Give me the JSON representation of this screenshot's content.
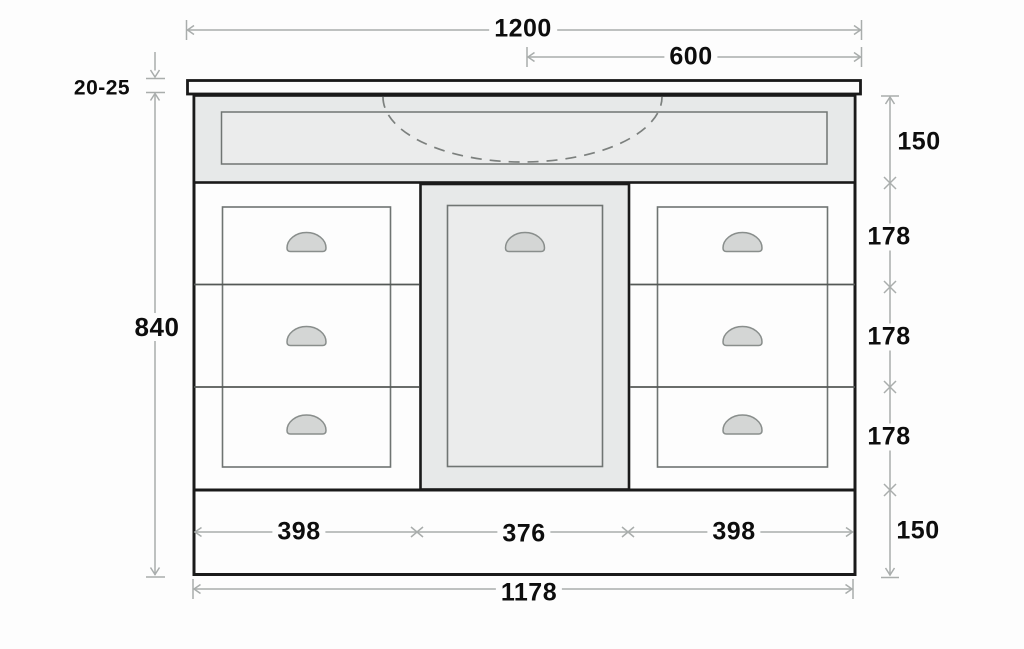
{
  "page": {
    "background": "#fdfdfd"
  },
  "diagram": {
    "name": "Vanity cabinet front elevation — dimension drawing",
    "units": "mm",
    "colors": {
      "outline": "#1a1a1a",
      "panel_fill": "#e7e9e9",
      "inset_panel_fill": "#ebecec",
      "handle_fill": "#d4d6d5",
      "dimension_line": "#a9adac",
      "label_text": "#0d0d0d"
    },
    "labels": {
      "overall_width": "1200",
      "half_width": "600",
      "countertop_thickness": "20-25",
      "cabinet_height": "840",
      "apron_height": "150",
      "drawer_top_height": "178",
      "drawer_middle_height": "178",
      "drawer_bottom_height": "178",
      "plinth_height": "150",
      "left_drawer_width": "398",
      "door_width": "376",
      "right_drawer_width": "398",
      "carcass_width": "1178"
    }
  }
}
